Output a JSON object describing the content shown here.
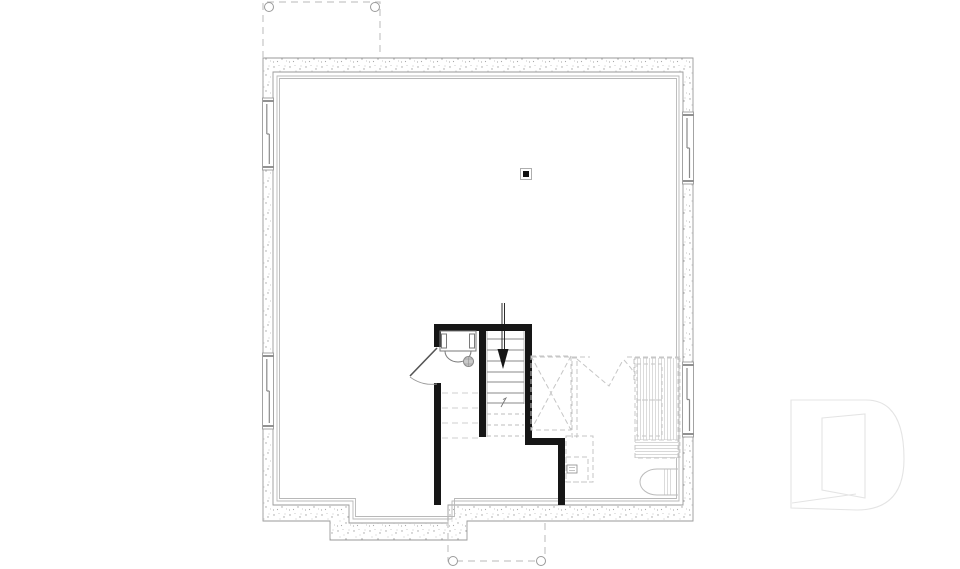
{
  "page": {
    "width": 960,
    "height": 569,
    "background": "#ffffff"
  },
  "colors": {
    "wall_outline": "#9a9a9a",
    "stipple_dot": "#a3a3a3",
    "finish_line": "#b8b8b8",
    "partition": "#161616",
    "tread": "#8a8a8a",
    "dashed": "#c6c6c6",
    "fixture": "#7a7a7a",
    "window_sash": "#8a8a8a",
    "window_cap": "#777777",
    "arrow": "#161616",
    "watermark": "#e4e4e4"
  },
  "watermark": {
    "letter": "D"
  },
  "plan": {
    "type": "basement-foundation-plan",
    "stairs": {
      "direction": "down",
      "solid_treads": 7,
      "dashed_treads": 3
    },
    "windows": [
      {
        "wall": "left",
        "span": "upper"
      },
      {
        "wall": "left",
        "span": "lower"
      },
      {
        "wall": "right",
        "span": "upper"
      },
      {
        "wall": "right",
        "span": "lower"
      }
    ],
    "porches": [
      {
        "position": "top",
        "posts": 2
      },
      {
        "position": "bottom",
        "posts": 2
      }
    ],
    "column_count": 1,
    "door_count": 1,
    "features": [
      "foundation-wall",
      "interior-finish-line",
      "left-windows",
      "right-windows",
      "top-porch-outline",
      "bottom-porch-outline",
      "interior-partitions",
      "door-swing",
      "bath-rough-in-fixtures",
      "floor-drain",
      "staircase-down-arrow",
      "steel-column",
      "mechanical-xbox",
      "future-door-dashes",
      "sump-boxes",
      "storage-shelving",
      "water-tank",
      "builder-watermark"
    ]
  }
}
